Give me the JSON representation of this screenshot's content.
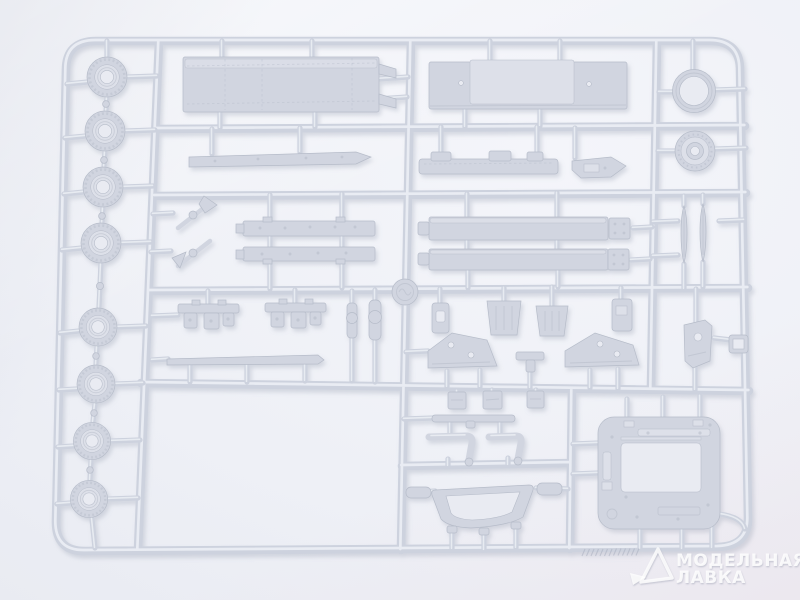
{
  "scene": {
    "description": "Photograph of a light-gray injection-molded plastic model kit sprue (parts frame) on a pale white background",
    "plastic_color_name": "light gray",
    "empty_region": "lower-left cell of the sprue has no parts"
  },
  "watermark": {
    "line1": "МОДЕЛЬНАЯ",
    "line2": "ЛАВКА",
    "logo": "triangle-ribbon-logo"
  },
  "palette": {
    "bg_top": "#f4f5fa",
    "bg_mid": "#eef0f6",
    "bg_bottom": "#e6e7ee",
    "plastic": "#cdd2de",
    "plastic_highlight": "#eaedf3",
    "plastic_shadow": "#8e96ab",
    "part_fill": "#d1d5e0",
    "part_light": "#dde0e9",
    "part_edge": "#b6bcc9",
    "hole": "#e9ebf2",
    "watermark": "#ffffff"
  },
  "parts": [
    {
      "name": "road-wheel",
      "count": 8,
      "location": "left column"
    },
    {
      "name": "flat-deck-panel",
      "count": 1,
      "location": "top left"
    },
    {
      "name": "superstructure-box",
      "count": 1,
      "location": "top center-right"
    },
    {
      "name": "large-ring",
      "count": 1,
      "location": "top right"
    },
    {
      "name": "wheel-hub",
      "count": 1,
      "location": "right column"
    },
    {
      "name": "narrow-blade",
      "count": 2,
      "location": "right column"
    },
    {
      "name": "fender-strip",
      "count": 1,
      "location": "upper left-center"
    },
    {
      "name": "chassis-rail",
      "count": 1,
      "location": "upper center"
    },
    {
      "name": "glacis-wedge",
      "count": 1,
      "location": "upper center-right"
    },
    {
      "name": "side-strip",
      "count": 2,
      "location": "middle left-center"
    },
    {
      "name": "tool-part",
      "count": 2,
      "location": "middle left"
    },
    {
      "name": "hull-side-slab",
      "count": 2,
      "location": "middle center-right"
    },
    {
      "name": "suspension-bogie",
      "count": 2,
      "location": "lower left-center"
    },
    {
      "name": "axle-rod",
      "count": 1,
      "location": "lower left-center"
    },
    {
      "name": "grille-bracket",
      "count": 2,
      "location": "center"
    },
    {
      "name": "triangular-plate",
      "count": 2,
      "location": "center"
    },
    {
      "name": "mount-bracket",
      "count": 1,
      "location": "right below middle"
    },
    {
      "name": "small-block",
      "count": 3,
      "location": "lower center"
    },
    {
      "name": "curved-pipe",
      "count": 2,
      "location": "lower center"
    },
    {
      "name": "hull-tub-frame",
      "count": 1,
      "location": "bottom center"
    },
    {
      "name": "hatch-frame",
      "count": 1,
      "location": "bottom right"
    }
  ]
}
